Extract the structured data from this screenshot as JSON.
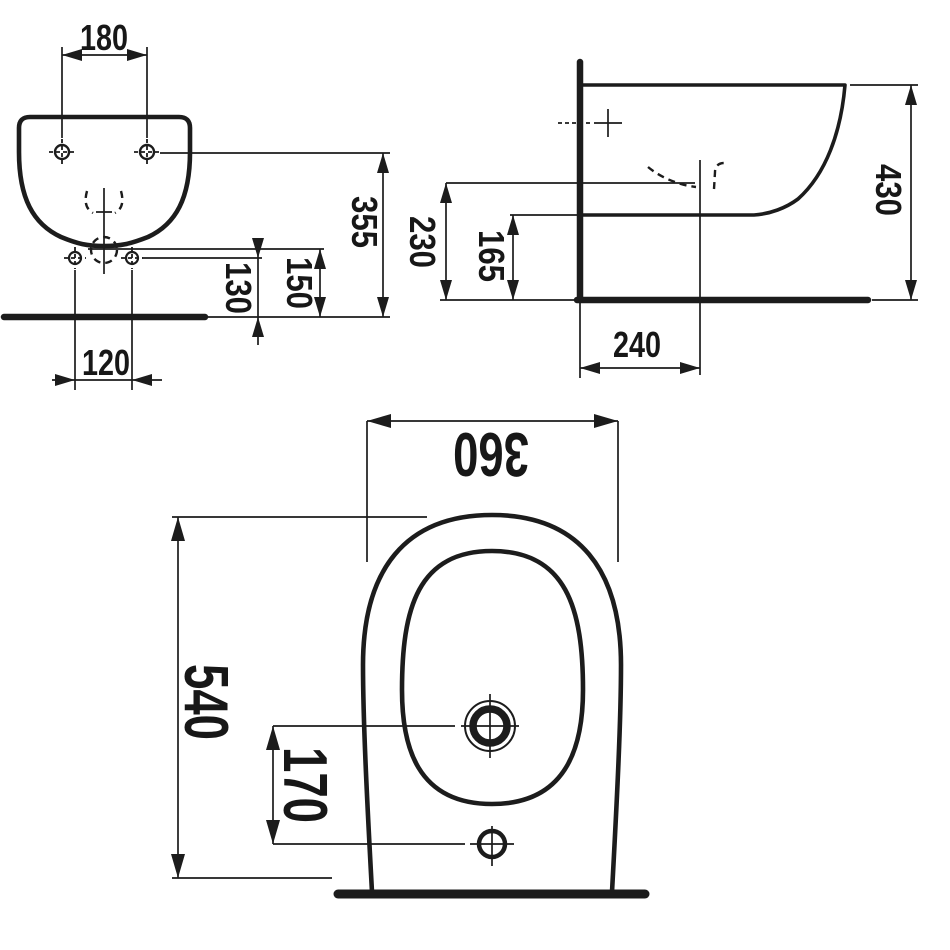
{
  "drawing": {
    "type": "technical-dimension-drawing",
    "subject": "wall-hung bidet, three orthographic views",
    "colors": {
      "background": "#ffffff",
      "ink": "#1c1c1c"
    },
    "views": {
      "front": {
        "dims": {
          "wall_hole_spacing": "180",
          "overall_height": "355",
          "outlet_height": "150",
          "side_hole_height": "130",
          "bottom_hole_spacing": "120"
        }
      },
      "side": {
        "dims": {
          "overall_height": "430",
          "tap_centre_height": "230",
          "underside_height": "165",
          "wall_to_tap": "240"
        }
      },
      "plan": {
        "dims": {
          "overall_width": "360",
          "overall_depth": "540",
          "hole_offset": "170"
        }
      }
    }
  }
}
